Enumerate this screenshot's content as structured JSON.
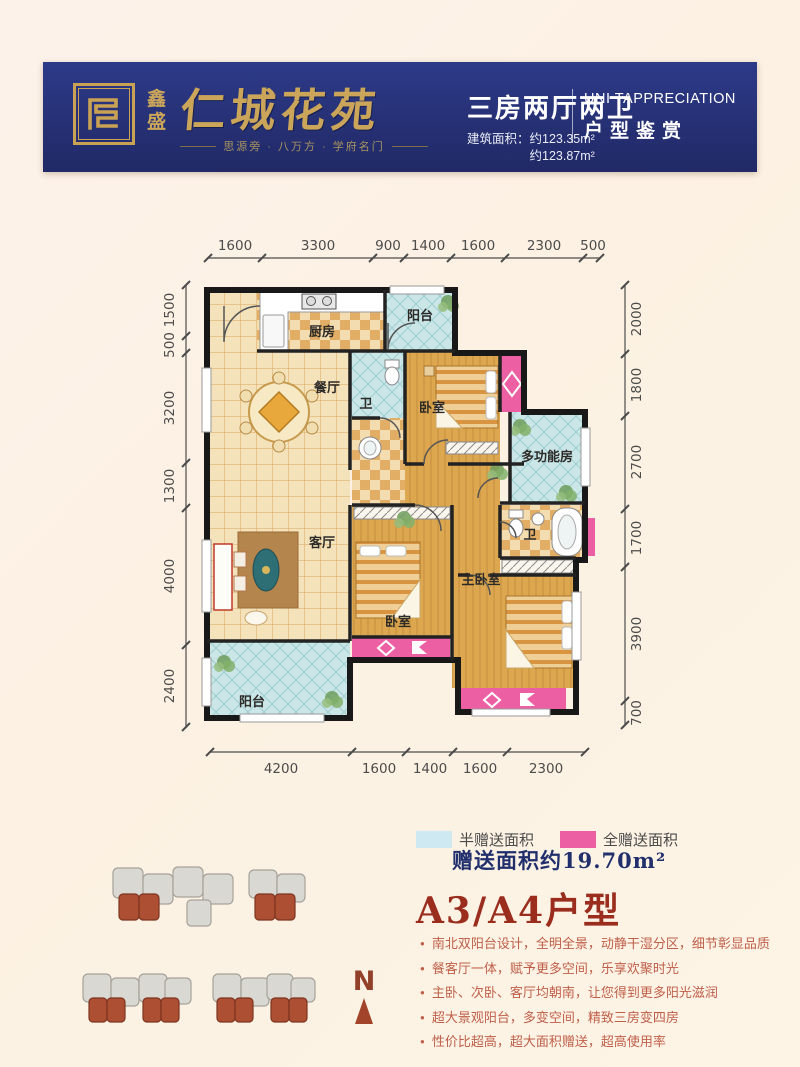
{
  "header": {
    "logo_small_1": "鑫",
    "logo_small_2": "盛",
    "brand_name": "仁城花苑",
    "tagline": "思源旁 · 八万方 · 学府名门",
    "layout_type": "三房两厅两卫",
    "area_label": "建筑面积：",
    "area_line1": "约123.35m²",
    "area_line2": "约123.87m²",
    "en_title": "UNI TAPPRECIATION",
    "cn_title": "户型鉴赏"
  },
  "plan": {
    "rooms": {
      "kitchen": "厨房",
      "balcony_north": "阳台",
      "dining": "餐厅",
      "bath1": "卫",
      "bedroom2": "卧室",
      "multi": "多功能房",
      "living": "客厅",
      "bedroom3": "卧室",
      "master": "主卧室",
      "bath2": "卫",
      "balcony_south": "阳台"
    },
    "dims_top": [
      "1600",
      "3300",
      "900",
      "1400",
      "1600",
      "2300",
      "500"
    ],
    "dims_bottom": [
      "4200",
      "1600",
      "1400",
      "1600",
      "2300"
    ],
    "dims_left": [
      "1500",
      "500",
      "3200",
      "1300",
      "4000",
      "2400"
    ],
    "dims_right": [
      "2000",
      "1800",
      "2700",
      "1700",
      "3900",
      "700"
    ]
  },
  "legend": {
    "half_label": "半赠送面积",
    "full_label": "全赠送面积",
    "gift_line": "赠送面积约19.70m²",
    "half_color": "#cfe9f2",
    "full_color": "#ec5fa2"
  },
  "unit": {
    "title": "A3/A4户型",
    "features": [
      "南北双阳台设计，全明全景，动静干湿分区，细节彰显品质",
      "餐客厅一体，赋予更多空间，乐享欢聚时光",
      "主卧、次卧、客厅均朝南，让您得到更多阳光滋润",
      "超大景观阳台，多变空间，精致三房变四房",
      "性价比超高，超大面积赠送，超高使用率"
    ]
  },
  "compass": {
    "label": "N"
  },
  "colors": {
    "banner_navy": "#242e70",
    "brand_gold": "#cba65a",
    "title_red": "#9a2d1e",
    "feature_red": "#bf5e49",
    "gift_navy": "#21306d",
    "pink_full": "#ec5fa2",
    "blue_half": "#cfe9f2"
  }
}
